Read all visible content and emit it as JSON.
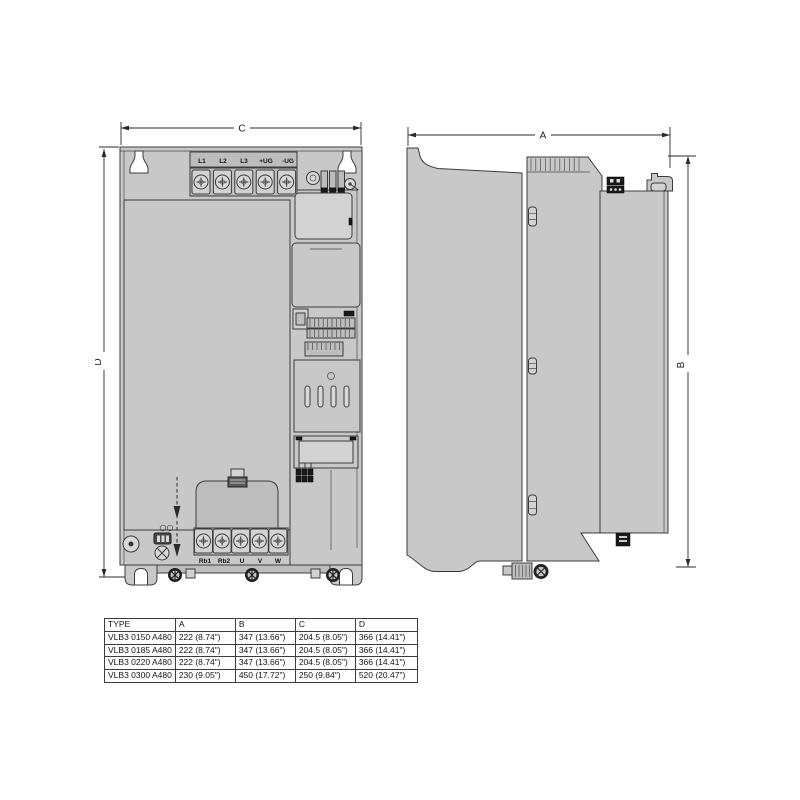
{
  "front_view": {
    "width_dim_label": "C",
    "height_dim_label": "D",
    "top_terminal_labels": [
      "L1",
      "L2",
      "L3",
      "+UG",
      "-UG"
    ],
    "bottom_terminal_labels": [
      "Rb1",
      "Rb2",
      "U",
      "V",
      "W"
    ]
  },
  "side_view": {
    "width_dim_label": "A",
    "height_dim_label": "B"
  },
  "dimension_table": {
    "headers": [
      "TYPE",
      "A",
      "B",
      "C",
      "D"
    ],
    "rows": [
      [
        "VLB3 0150 A480",
        "222 (8.74\")",
        "347 (13.66\")",
        "204.5 (8.05\")",
        "366 (14.41\")"
      ],
      [
        "VLB3 0185 A480",
        "222 (8.74\")",
        "347 (13.66\")",
        "204.5 (8.05\")",
        "366 (14.41\")"
      ],
      [
        "VLB3 0220 A480",
        "222 (8.74\")",
        "347 (13.66\")",
        "204.5 (8.05\")",
        "366 (14.41\")"
      ],
      [
        "VLB3 0300 A480",
        "230 (9.05\")",
        "450 (17.72\")",
        "250 (9.84\")",
        "520 (20.47\")"
      ]
    ]
  },
  "colors": {
    "device_gray": "#c8c8c8",
    "panel_gray": "#d2d2d2",
    "line": "#3c3c3c",
    "detail_black": "#1a1a1a",
    "background": "#ffffff"
  }
}
